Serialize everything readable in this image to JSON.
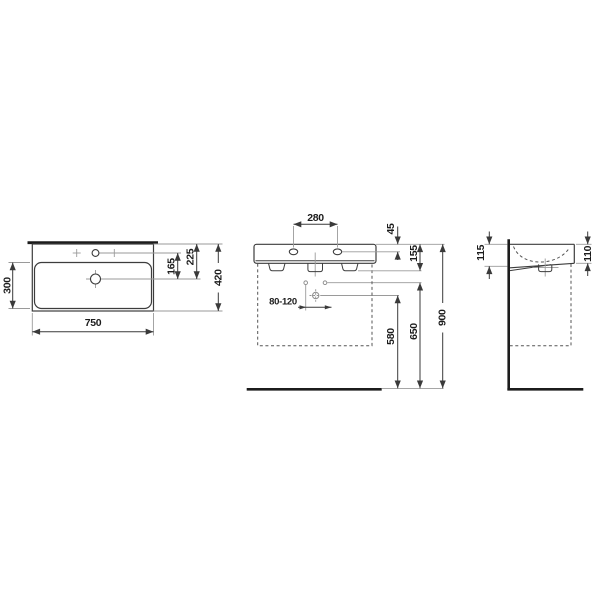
{
  "drawing": {
    "kind": "technical-dimension-drawing",
    "subject": "wall-mounted washbasin, three orthographic views",
    "unit": "mm",
    "colors": {
      "background": "#ffffff",
      "object_outline": "#3d3d3d",
      "thick_line": "#1c1c1c",
      "extension_line": "#9a9a9a",
      "dimension_line": "#3a3a3a",
      "text": "#1c1c1c"
    },
    "views": {
      "plan": {
        "name": "top view",
        "dims": [
          {
            "id": "bowl-depth",
            "label": "300"
          },
          {
            "id": "overall-width",
            "label": "750"
          },
          {
            "id": "tap-to-drain",
            "label": "165"
          },
          {
            "id": "back-to-drain",
            "label": "225"
          },
          {
            "id": "overall-depth",
            "label": "420"
          }
        ]
      },
      "front": {
        "name": "front view",
        "dims": [
          {
            "id": "tap-hole-spacing",
            "label": "280"
          },
          {
            "id": "top-to-tap-holes",
            "label": "45"
          },
          {
            "id": "top-to-fixing",
            "label": "155"
          },
          {
            "id": "drain-offset-range",
            "label": "80-120"
          },
          {
            "id": "drain-height",
            "label": "580"
          },
          {
            "id": "connection-height",
            "label": "650"
          },
          {
            "id": "rim-height",
            "label": "900"
          }
        ]
      },
      "side": {
        "name": "side view",
        "dims": [
          {
            "id": "height-at-wall",
            "label": "115"
          },
          {
            "id": "height-at-front",
            "label": "110"
          }
        ]
      }
    }
  }
}
